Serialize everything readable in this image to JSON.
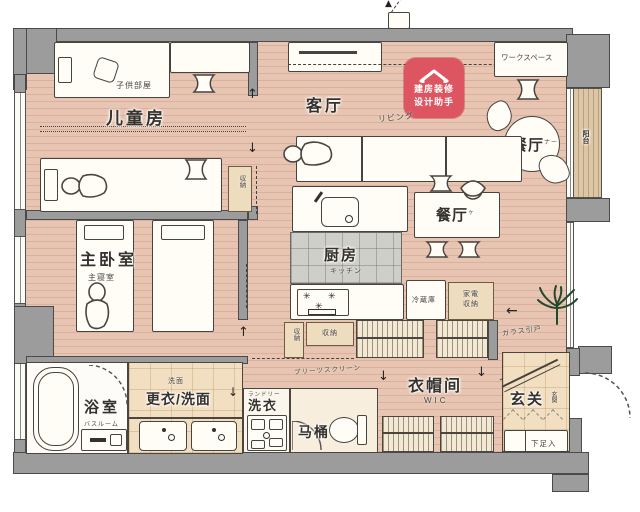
{
  "rooms": {
    "kids": {
      "name": "儿童房",
      "jp": "子供部屋"
    },
    "master": {
      "name": "主卧室",
      "jp": "主寝室"
    },
    "living": {
      "name": "客厅",
      "jp": "リビング"
    },
    "dining1": {
      "name": "餐厅",
      "jp": "ナー"
    },
    "dining2": {
      "name": "餐厅",
      "jp": "ヶ"
    },
    "kitchen": {
      "name": "厨房",
      "jp": "キッチン"
    },
    "bath": {
      "name": "浴室",
      "jp": "バスルーム"
    },
    "dressing": {
      "name": "更衣/洗面",
      "jp": "洗面"
    },
    "laundry": {
      "name": "洗衣",
      "jp": "ランドリー"
    },
    "toilet": {
      "name": "马桶"
    },
    "wic": {
      "name": "衣帽间",
      "jp": "WIC"
    },
    "entry": {
      "name": "玄关",
      "jp": "玄関"
    },
    "balcony": {
      "name": "阳台"
    },
    "workspace": {
      "name": "ワークスペース"
    }
  },
  "fixtures": {
    "fridge": "冷蔵庫",
    "appliance1": "家電",
    "appliance2": "収納",
    "storage": "収納",
    "pleats": "プリーツスクリーン",
    "glass_door": "ガラス引戸",
    "shoe": "下足入"
  },
  "badge": {
    "line1": "建房装修",
    "line2": "设计助手"
  },
  "icons": {
    "arrow_up": "↑",
    "arrow_down": "↓",
    "arrow_left": "←",
    "burner": "✳"
  },
  "colors": {
    "wall": "#9c9c9c",
    "wood": "#e7c5b2",
    "accent": "#dc5560",
    "tile_beige": "#f2dfc2",
    "tile_gray": "#cfcfc9",
    "line": "#474440",
    "storage": "#eedcbf",
    "plant": "#24482c"
  }
}
